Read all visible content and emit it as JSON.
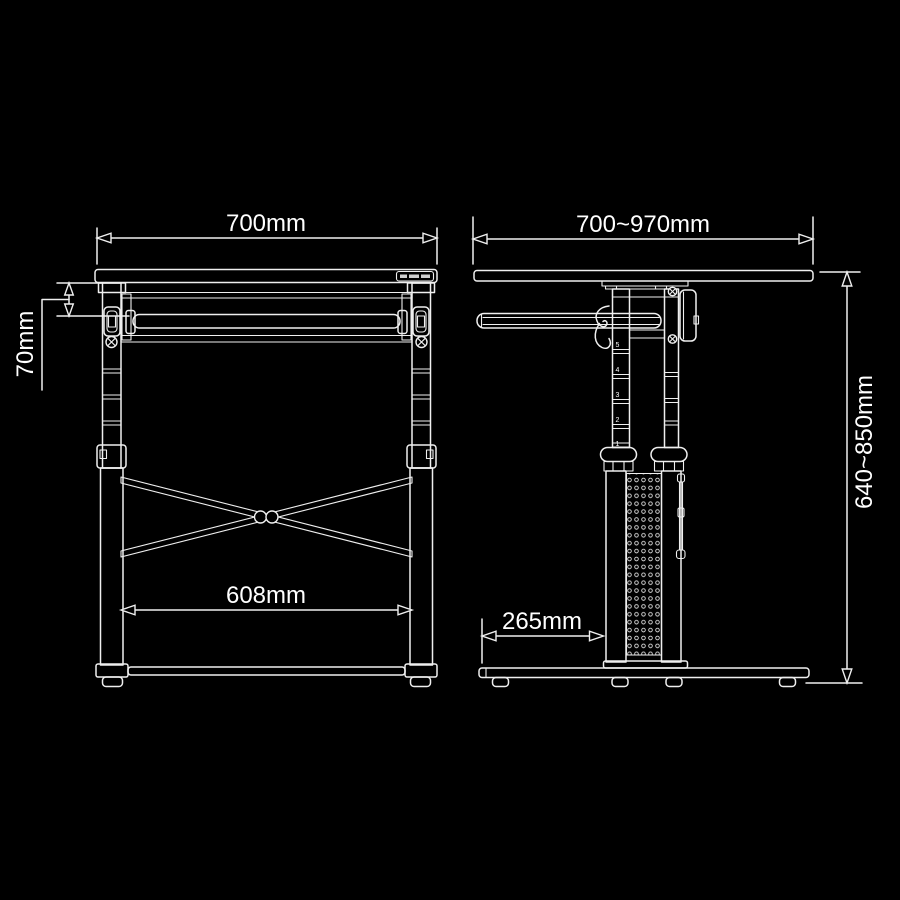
{
  "colors": {
    "background": "#000000",
    "line": "#efefef",
    "text": "#ffffff"
  },
  "front_view": {
    "width_label": "700mm",
    "tray_drop_label": "70mm",
    "inner_span_label": "608mm"
  },
  "side_view": {
    "depth_label": "700~970mm",
    "height_label": "640~850mm",
    "base_depth_label": "265mm",
    "scale_numbers": [
      "5",
      "4",
      "3",
      "2",
      "1"
    ]
  }
}
